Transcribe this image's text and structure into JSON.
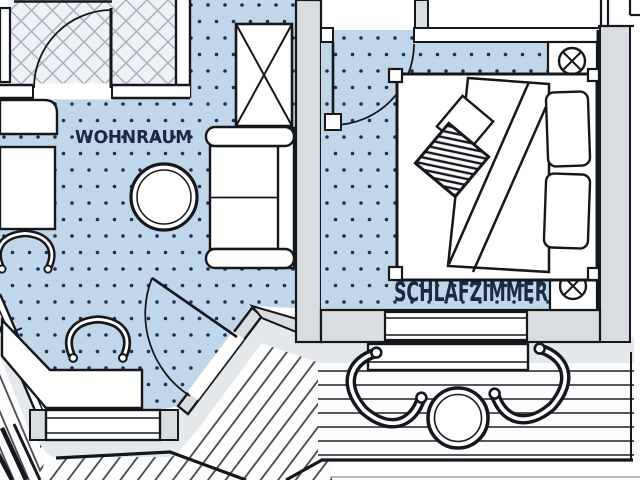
{
  "document": {
    "type": "apartment-floor-plan"
  },
  "rooms": [
    {
      "id": "wohnraum",
      "label": "WOHNRAUM"
    },
    {
      "id": "schlafzimmer",
      "label": "SCHLAFZIMMER"
    }
  ],
  "colors": {
    "floor_dotted": "#bfd7e9",
    "dot": "#1e2f52",
    "outline": "#14181d",
    "wall_fill": "#d9dde1",
    "walkway": "#e5e8eb",
    "tile_floor": "#eef2f6",
    "tile_line": "#a7b1bc",
    "plank_line": "#41474f",
    "label_text": "#1c2844"
  },
  "furniture": [
    "wardrobe",
    "sofa",
    "round-table",
    "armchair",
    "armchair",
    "corner-desk",
    "counter",
    "side-table",
    "double-bed",
    "pillow",
    "pillow",
    "cushion",
    "striped-cushion",
    "blanket",
    "terrace-chair",
    "terrace-chair",
    "terrace-table",
    "window-bench"
  ],
  "symbols": [
    "circled-x-symbol",
    "circled-x-symbol",
    "door-swing",
    "door-swing",
    "door-swing",
    "window",
    "window",
    "window"
  ]
}
